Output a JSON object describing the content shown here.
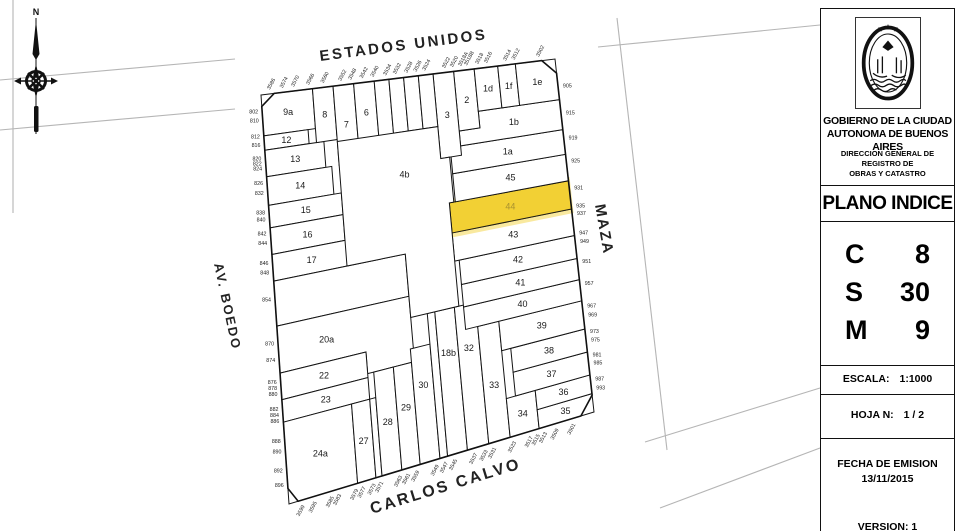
{
  "highlight_color": "#f2ce2b",
  "compass": {
    "north_label": "N"
  },
  "panel": {
    "org_line1": "GOBIERNO DE LA CIUDAD",
    "org_line2": "AUTONOMA DE BUENOS AIRES",
    "dept_line1": "DIRECCION GENERAL DE REGISTRO DE",
    "dept_line2": "OBRAS Y CATASTRO",
    "title": "PLANO INDICE",
    "rows": [
      {
        "key": "C",
        "value": "8"
      },
      {
        "key": "S",
        "value": "30"
      },
      {
        "key": "M",
        "value": "9"
      }
    ],
    "escala_label": "ESCALA:",
    "escala_value": "1:1000",
    "hoja_label": "HOJA N:",
    "hoja_value": "1 / 2",
    "fecha_label": "FECHA DE EMISION",
    "fecha_value": "13/11/2015",
    "version_label": "VERSION: 1"
  },
  "map": {
    "quad": {
      "tl": [
        261,
        95
      ],
      "tr": [
        555,
        59
      ],
      "br": [
        594,
        412
      ],
      "bl": [
        289,
        504
      ]
    },
    "outline_uv": [
      [
        0.045,
        0
      ],
      [
        0.955,
        0
      ],
      [
        1,
        0.04
      ],
      [
        1,
        0.952
      ],
      [
        0.957,
        1
      ],
      [
        0.03,
        1
      ],
      [
        0,
        0.962
      ],
      [
        0,
        0.028
      ]
    ],
    "context_lines": [
      [
        0,
        80,
        235,
        59
      ],
      [
        0,
        130,
        235,
        109
      ],
      [
        13,
        0,
        13,
        213
      ],
      [
        617,
        18,
        667,
        450
      ],
      [
        598,
        47,
        820,
        25
      ],
      [
        645,
        442,
        820,
        388
      ],
      [
        660,
        508,
        820,
        448
      ]
    ],
    "streets": [
      {
        "name": "ESTADOS UNIDOS",
        "x": 404,
        "y": 50,
        "rot": -7.5,
        "size": 15,
        "ls": 2.5,
        "anchor": "middle"
      },
      {
        "name": "CARLOS CALVO",
        "x": 447,
        "y": 491,
        "rot": -17,
        "size": 16,
        "ls": 2.5,
        "anchor": "middle"
      },
      {
        "name": "AV. BOEDO",
        "x": 214,
        "y": 264,
        "rot": 78,
        "size": 13,
        "ls": 2,
        "anchor": "start"
      },
      {
        "name": "MAZA",
        "x": 595,
        "y": 205,
        "rot": 80,
        "size": 15,
        "ls": 2,
        "anchor": "start"
      }
    ],
    "parcels": [
      {
        "label": "9a",
        "r": [
          0,
          0,
          0.175,
          0.1
        ]
      },
      {
        "label": "12",
        "r": [
          0,
          0.1,
          0.15,
          0.135
        ]
      },
      {
        "label": "13",
        "r": [
          0,
          0.135,
          0.2,
          0.2
        ]
      },
      {
        "label": "14",
        "r": [
          0,
          0.2,
          0.22,
          0.27
        ]
      },
      {
        "label": "15",
        "r": [
          0,
          0.27,
          0.245,
          0.325
        ]
      },
      {
        "label": "16",
        "r": [
          0,
          0.325,
          0.245,
          0.39
        ]
      },
      {
        "label": "17",
        "r": [
          0,
          0.39,
          0.26,
          0.455
        ]
      },
      {
        "label": "",
        "r": [
          0,
          0.455,
          0.44,
          0.565
        ]
      },
      {
        "label": "20a",
        "poly": [
          [
            0,
            0.565
          ],
          [
            0.44,
            0.565
          ],
          [
            0.44,
            0.735
          ],
          [
            0.285,
            0.735
          ],
          [
            0.285,
            0.68
          ],
          [
            0,
            0.68
          ]
        ],
        "lu": 0.16,
        "lv": 0.625
      },
      {
        "label": "22",
        "r": [
          0,
          0.68,
          0.285,
          0.745
        ]
      },
      {
        "label": "23",
        "r": [
          0,
          0.745,
          0.285,
          0.8
        ]
      },
      {
        "label": "24a",
        "r": [
          0,
          0.8,
          0.225,
          1
        ]
      },
      {
        "label": "27",
        "r": [
          0.225,
          0.8,
          0.285,
          1
        ]
      },
      {
        "label": "",
        "r": [
          0.285,
          0.8,
          0.305,
          1
        ]
      },
      {
        "label": "28",
        "r": [
          0.305,
          0.735,
          0.37,
          1
        ],
        "lv": 0.87
      },
      {
        "label": "29",
        "r": [
          0.37,
          0.735,
          0.43,
          1
        ],
        "lv": 0.845
      },
      {
        "label": "30",
        "r": [
          0.43,
          0.7,
          0.495,
          1
        ],
        "lv": 0.8
      },
      {
        "label": "",
        "r": [
          0.495,
          0.62,
          0.52,
          1
        ]
      },
      {
        "label": "18b",
        "r": [
          0.52,
          0.62,
          0.585,
          1
        ],
        "lv": 0.735
      },
      {
        "label": "32",
        "r": [
          0.585,
          0.62,
          0.655,
          1
        ],
        "lv": 0.735
      },
      {
        "label": "33",
        "r": [
          0.655,
          0.685,
          0.725,
          1
        ],
        "lv": 0.85
      },
      {
        "label": "34",
        "r": [
          0.725,
          0.895,
          0.82,
          1
        ]
      },
      {
        "label": "35",
        "r": [
          0.82,
          0.948,
          1,
          1
        ]
      },
      {
        "label": "36",
        "r": [
          0.82,
          0.895,
          1,
          0.948
        ]
      },
      {
        "label": "37",
        "r": [
          0.755,
          0.83,
          1,
          0.895
        ]
      },
      {
        "label": "38",
        "r": [
          0.755,
          0.765,
          1,
          0.83
        ]
      },
      {
        "label": "39",
        "r": [
          0.725,
          0.685,
          1,
          0.765
        ]
      },
      {
        "label": "40",
        "r": [
          0.615,
          0.625,
          1,
          0.685
        ]
      },
      {
        "label": "41",
        "r": [
          0.615,
          0.565,
          1,
          0.625
        ]
      },
      {
        "label": "42",
        "r": [
          0.615,
          0.5,
          1,
          0.565
        ]
      },
      {
        "label": "43",
        "r": [
          0.6,
          0.425,
          1,
          0.5
        ]
      },
      {
        "label": "44",
        "r": [
          0.6,
          0.345,
          1,
          0.425
        ],
        "hl": true
      },
      {
        "label": "45",
        "r": [
          0.62,
          0.27,
          1,
          0.345
        ]
      },
      {
        "label": "1a",
        "r": [
          0.62,
          0.2,
          1,
          0.27
        ]
      },
      {
        "label": "1b",
        "poly": [
          [
            0.725,
            0.115
          ],
          [
            1,
            0.115
          ],
          [
            1,
            0.2
          ],
          [
            0.655,
            0.2
          ],
          [
            0.655,
            0.16
          ],
          [
            0.725,
            0.16
          ]
        ],
        "lu": 0.84,
        "lv": 0.158
      },
      {
        "label": "2",
        "r": [
          0.655,
          0,
          0.725,
          0.16
        ]
      },
      {
        "label": "3",
        "r": [
          0.585,
          0,
          0.655,
          0.225
        ]
      },
      {
        "label": "1d",
        "r": [
          0.725,
          0,
          0.805,
          0.115
        ]
      },
      {
        "label": "1f",
        "r": [
          0.805,
          0,
          0.865,
          0.115
        ]
      },
      {
        "label": "1e",
        "r": [
          0.865,
          0,
          1,
          0.115
        ]
      },
      {
        "label": "8",
        "r": [
          0.175,
          0,
          0.245,
          0.135
        ]
      },
      {
        "label": "7",
        "r": [
          0.245,
          0,
          0.315,
          0.2
        ]
      },
      {
        "label": "6",
        "r": [
          0.315,
          0,
          0.385,
          0.155
        ]
      },
      {
        "label": "",
        "r": [
          0.385,
          0,
          0.435,
          0.155
        ]
      },
      {
        "label": "",
        "r": [
          0.435,
          0,
          0.485,
          0.14
        ]
      },
      {
        "label": "",
        "r": [
          0.485,
          0,
          0.535,
          0.14
        ]
      },
      {
        "label": "",
        "r": [
          0.535,
          0,
          0.585,
          0.14
        ]
      },
      {
        "label": "4b",
        "poly": [
          [
            0.245,
            0.14
          ],
          [
            0.585,
            0.14
          ],
          [
            0.585,
            0.225
          ],
          [
            0.615,
            0.225
          ],
          [
            0.615,
            0.345
          ],
          [
            0.6,
            0.345
          ],
          [
            0.6,
            0.62
          ],
          [
            0.44,
            0.62
          ],
          [
            0.44,
            0.455
          ],
          [
            0.245,
            0.455
          ]
        ],
        "lu": 0.46,
        "lv": 0.25
      }
    ],
    "addresses": {
      "left": [
        {
          "t": "802",
          "v": 0.04
        },
        {
          "t": "810",
          "v": 0.062
        },
        {
          "t": "812",
          "v": 0.102
        },
        {
          "t": "816",
          "v": 0.122
        },
        {
          "t": "820",
          "v": 0.155
        },
        {
          "t": "822",
          "v": 0.167
        },
        {
          "t": "824",
          "v": 0.18
        },
        {
          "t": "826",
          "v": 0.215
        },
        {
          "t": "832",
          "v": 0.24
        },
        {
          "t": "838",
          "v": 0.287
        },
        {
          "t": "840",
          "v": 0.304
        },
        {
          "t": "842",
          "v": 0.339
        },
        {
          "t": "844",
          "v": 0.362
        },
        {
          "t": "846",
          "v": 0.411
        },
        {
          "t": "848",
          "v": 0.434
        },
        {
          "t": "854",
          "v": 0.5
        },
        {
          "t": "870",
          "v": 0.608
        },
        {
          "t": "874",
          "v": 0.648
        },
        {
          "t": "876",
          "v": 0.702
        },
        {
          "t": "878",
          "v": 0.716
        },
        {
          "t": "880",
          "v": 0.731
        },
        {
          "t": "882",
          "v": 0.768
        },
        {
          "t": "884",
          "v": 0.782
        },
        {
          "t": "886",
          "v": 0.797
        },
        {
          "t": "888",
          "v": 0.846
        },
        {
          "t": "890",
          "v": 0.872
        },
        {
          "t": "892",
          "v": 0.918
        },
        {
          "t": "896",
          "v": 0.953
        }
      ],
      "right": [
        {
          "t": "905",
          "v": 0.075
        },
        {
          "t": "915",
          "v": 0.152
        },
        {
          "t": "919",
          "v": 0.222
        },
        {
          "t": "925",
          "v": 0.288
        },
        {
          "t": "931",
          "v": 0.364
        },
        {
          "t": "935",
          "v": 0.415
        },
        {
          "t": "937",
          "v": 0.436
        },
        {
          "t": "947",
          "v": 0.492
        },
        {
          "t": "949",
          "v": 0.515
        },
        {
          "t": "951",
          "v": 0.572
        },
        {
          "t": "957",
          "v": 0.634
        },
        {
          "t": "967",
          "v": 0.698
        },
        {
          "t": "969",
          "v": 0.724
        },
        {
          "t": "973",
          "v": 0.77
        },
        {
          "t": "975",
          "v": 0.795
        },
        {
          "t": "981",
          "v": 0.837
        },
        {
          "t": "985",
          "v": 0.86
        },
        {
          "t": "987",
          "v": 0.905
        },
        {
          "t": "993",
          "v": 0.93
        }
      ],
      "top": [
        {
          "t": "3586",
          "u": 0.03
        },
        {
          "t": "3574",
          "u": 0.073
        },
        {
          "t": "3570",
          "u": 0.112
        },
        {
          "t": "3566",
          "u": 0.163
        },
        {
          "t": "3560",
          "u": 0.212
        },
        {
          "t": "3552",
          "u": 0.272
        },
        {
          "t": "3548",
          "u": 0.306
        },
        {
          "t": "3542",
          "u": 0.345
        },
        {
          "t": "3540",
          "u": 0.382
        },
        {
          "t": "3534",
          "u": 0.425
        },
        {
          "t": "3532",
          "u": 0.458
        },
        {
          "t": "3528",
          "u": 0.497
        },
        {
          "t": "3526",
          "u": 0.528
        },
        {
          "t": "3524",
          "u": 0.558
        },
        {
          "t": "3522",
          "u": 0.625
        },
        {
          "t": "3520",
          "u": 0.652
        },
        {
          "t": "3518A",
          "u": 0.68
        },
        {
          "t": "3518B",
          "u": 0.7
        },
        {
          "t": "3518",
          "u": 0.738
        },
        {
          "t": "3516",
          "u": 0.768
        },
        {
          "t": "3514",
          "u": 0.833
        },
        {
          "t": "3512",
          "u": 0.862
        },
        {
          "t": "3502",
          "u": 0.945
        }
      ],
      "bottom": [
        {
          "t": "3599",
          "u": 0.052
        },
        {
          "t": "3595",
          "u": 0.092
        },
        {
          "t": "3585",
          "u": 0.148
        },
        {
          "t": "3583",
          "u": 0.172
        },
        {
          "t": "3579",
          "u": 0.228
        },
        {
          "t": "3577",
          "u": 0.252
        },
        {
          "t": "3573",
          "u": 0.285
        },
        {
          "t": "3571",
          "u": 0.31
        },
        {
          "t": "3563",
          "u": 0.372
        },
        {
          "t": "3561",
          "u": 0.398
        },
        {
          "t": "3559",
          "u": 0.428
        },
        {
          "t": "3549",
          "u": 0.492
        },
        {
          "t": "3547",
          "u": 0.522
        },
        {
          "t": "3545",
          "u": 0.552
        },
        {
          "t": "3537",
          "u": 0.618
        },
        {
          "t": "3533",
          "u": 0.652
        },
        {
          "t": "3531",
          "u": 0.68
        },
        {
          "t": "3523",
          "u": 0.745
        },
        {
          "t": "3517",
          "u": 0.8
        },
        {
          "t": "3515",
          "u": 0.823
        },
        {
          "t": "3513",
          "u": 0.847
        },
        {
          "t": "3509",
          "u": 0.885
        },
        {
          "t": "3501",
          "u": 0.94
        }
      ]
    }
  }
}
